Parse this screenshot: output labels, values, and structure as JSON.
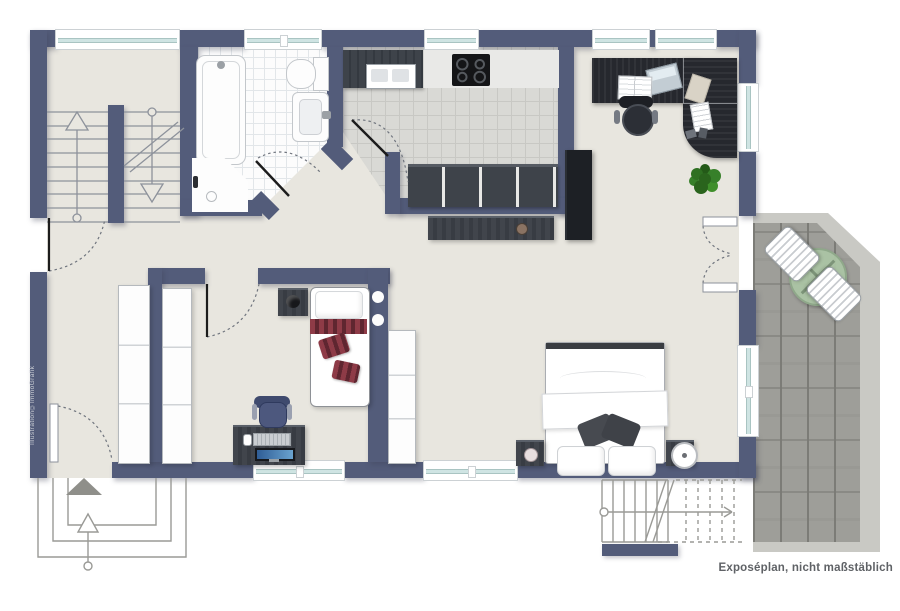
{
  "document": {
    "type": "apartment floor plan",
    "caption": "Exposéplan, nicht maßstäblich",
    "watermark": "Illustration©ImmoGrafik"
  },
  "palette": {
    "wall": "#535C7A",
    "interior_floor": "#E8E6DF",
    "bath_floor": "#FCFCFC",
    "kitchen_floor": "#D9D9D5",
    "terrace_paver": "#9E9E99",
    "terrace_border": "#C9C9C4",
    "window_glass": "#CFE4E3",
    "furniture_dark": "#33373E",
    "cushion_red": "#8E3B47",
    "plant_green": "#3F8F2B",
    "outline_gray": "#8D929B"
  },
  "plan": {
    "rooms": [
      {
        "id": "stairwell",
        "fixtures": [
          "u-shaped staircase",
          "up arrow",
          "down arrow",
          "window"
        ]
      },
      {
        "id": "bathroom",
        "fixtures": [
          "bathtub",
          "corner shower",
          "washbasin",
          "toilet",
          "window",
          "white tiled floor"
        ]
      },
      {
        "id": "kitchen",
        "fixtures": [
          "countertop with sink",
          "cooktop",
          "base cabinets",
          "tall cabinet",
          "window",
          "grey tiled floor"
        ]
      },
      {
        "id": "living-area",
        "fixtures": [
          "corner desk",
          "office chair",
          "laptop",
          "open book",
          "papers",
          "plant",
          "sideboard",
          "french door to terrace"
        ]
      },
      {
        "id": "kids-room",
        "fixtures": [
          "single bed",
          "striped red cushions",
          "nightstand",
          "desk with monitor",
          "desk chair",
          "wardrobe",
          "window"
        ]
      },
      {
        "id": "hallway",
        "fixtures": [
          "wardrobe",
          "entrance door",
          "entrance arrow",
          "outside steps"
        ]
      },
      {
        "id": "sleeping-area",
        "fixtures": [
          "double bed",
          "two nightstands",
          "alarm clock",
          "wardrobe",
          "window"
        ]
      },
      {
        "id": "terrace",
        "fixtures": [
          "stone pavers",
          "round glass table",
          "two slatted chairs",
          "exterior stairs down"
        ]
      }
    ]
  }
}
